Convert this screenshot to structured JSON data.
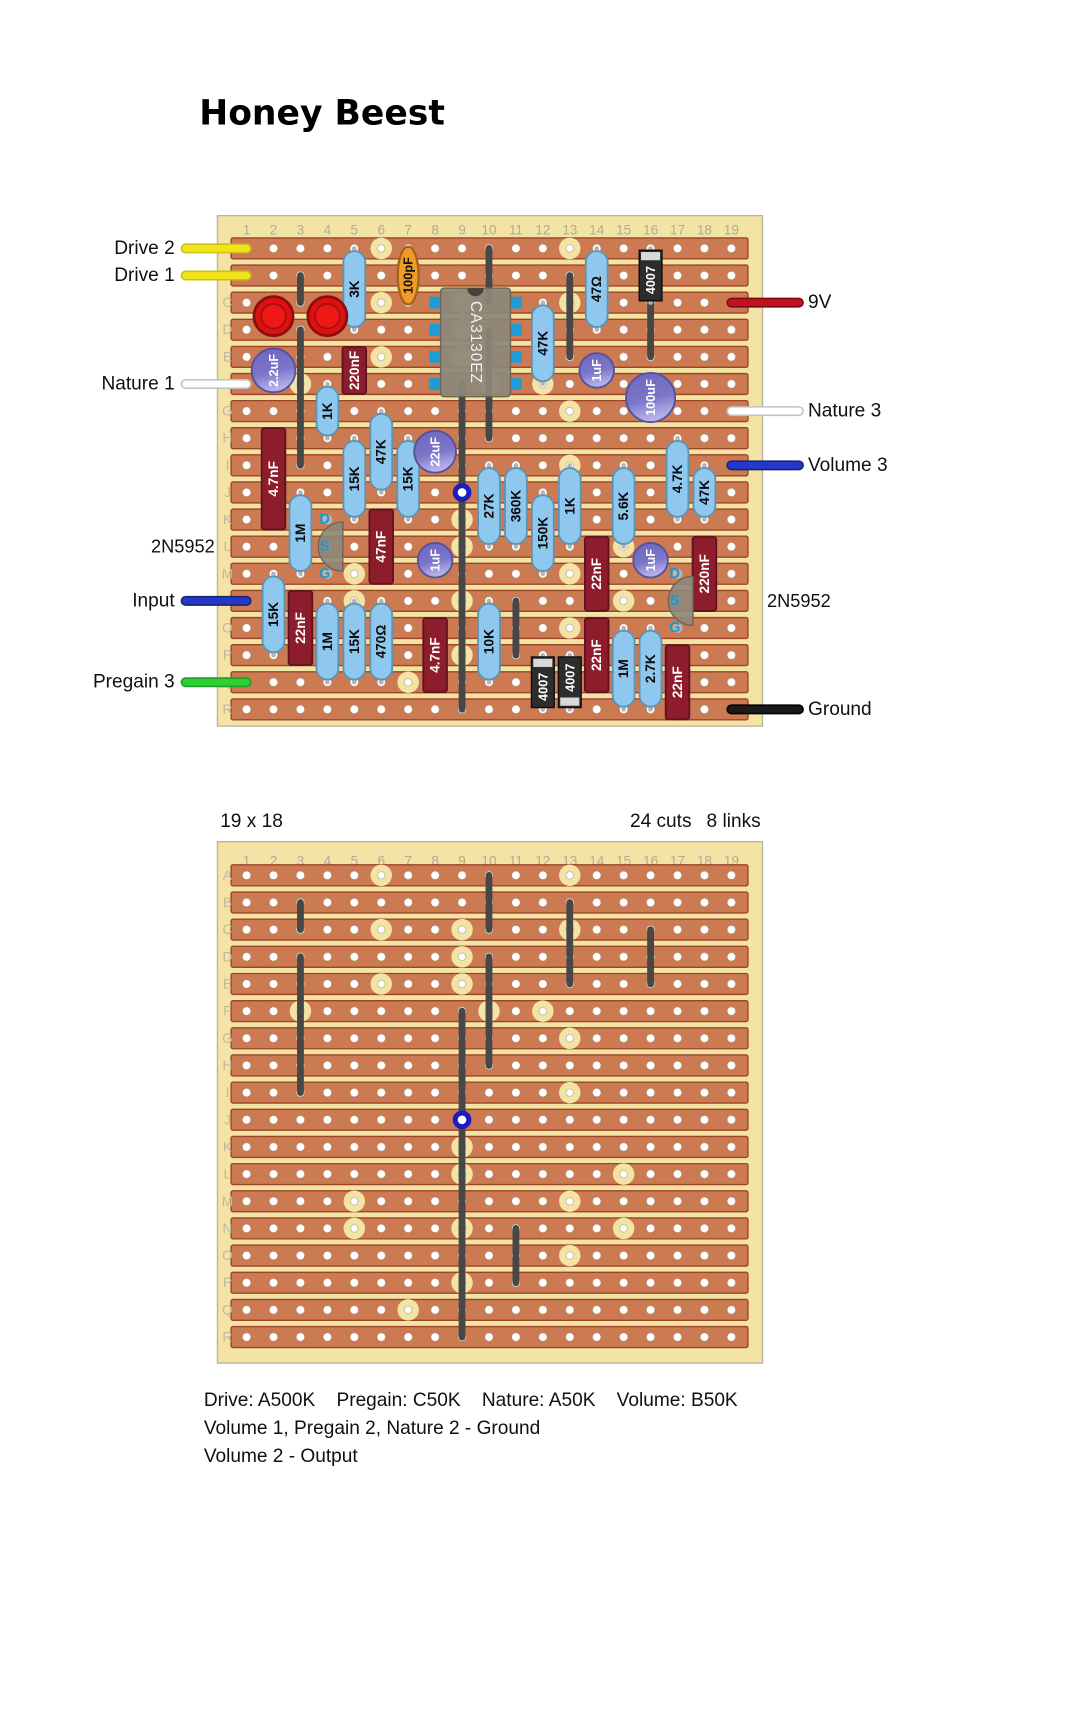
{
  "title": "Honey Beest",
  "board_meta": {
    "size_label": "19 x 18",
    "cuts_label": "24 cuts",
    "links_label": "8 links"
  },
  "captions": [
    "Drive: A500K    Pregain: C50K    Nature: A50K    Volume: B50K",
    "Volume 1, Pregain 2, Nature 2 - Ground",
    "Volume 2 - Output"
  ],
  "grid": {
    "columns": 19,
    "rows": "ABCDEFGHIJKLMNOPQR"
  },
  "connections": {
    "left": [
      {
        "label": "Drive 2",
        "row": "A",
        "color": "#f2e51c",
        "edge": "#cdc010"
      },
      {
        "label": "Drive 1",
        "row": "B",
        "color": "#f2e51c",
        "edge": "#cdc010"
      },
      {
        "label": "Nature 1",
        "row": "F",
        "color": "#ffffff",
        "edge": "#c3c3c3"
      },
      {
        "label": "Input",
        "row": "N",
        "color": "#2438cc",
        "edge": "#17246f"
      },
      {
        "label": "Pregain 3",
        "row": "Q",
        "color": "#2ecf35",
        "edge": "#1f9e28"
      }
    ],
    "right": [
      {
        "label": "9V",
        "row": "C",
        "color": "#c1121e",
        "edge": "#7d0a12"
      },
      {
        "label": "Nature 3",
        "row": "G",
        "color": "#ffffff",
        "edge": "#c3c3c3"
      },
      {
        "label": "Volume 3",
        "row": "I",
        "color": "#2438cc",
        "edge": "#17246f"
      },
      {
        "label": "Ground",
        "row": "R",
        "color": "#1a1a1a",
        "edge": "#000000"
      }
    ],
    "annotations": [
      {
        "label": "2N5952",
        "side": "left",
        "row": "L"
      },
      {
        "label": "2N5952",
        "side": "right",
        "row": "N"
      }
    ]
  },
  "components": {
    "resistors": [
      {
        "value": "3K",
        "col": 5,
        "from": "A",
        "to": "D"
      },
      {
        "value": "47Ω",
        "col": 14,
        "from": "A",
        "to": "D"
      },
      {
        "value": "47K",
        "col": 12,
        "from": "C",
        "to": "F"
      },
      {
        "value": "1K",
        "col": 4,
        "from": "F",
        "to": "H"
      },
      {
        "value": "47K",
        "col": 6,
        "from": "G",
        "to": "J"
      },
      {
        "value": "15K",
        "col": 5,
        "from": "H",
        "to": "K"
      },
      {
        "value": "15K",
        "col": 7,
        "from": "H",
        "to": "K"
      },
      {
        "value": "27K",
        "col": 10,
        "from": "I",
        "to": "L"
      },
      {
        "value": "360K",
        "col": 11,
        "from": "I",
        "to": "L"
      },
      {
        "value": "1K",
        "col": 13,
        "from": "I",
        "to": "L"
      },
      {
        "value": "5.6K",
        "col": 15,
        "from": "I",
        "to": "L"
      },
      {
        "value": "150K",
        "col": 12,
        "from": "J",
        "to": "M"
      },
      {
        "value": "4.7K",
        "col": 17,
        "from": "H",
        "to": "K"
      },
      {
        "value": "47K",
        "col": 18,
        "from": "I",
        "to": "K"
      },
      {
        "value": "1M",
        "col": 3,
        "from": "J",
        "to": "M"
      },
      {
        "value": "15K",
        "col": 2,
        "from": "M",
        "to": "P"
      },
      {
        "value": "1M",
        "col": 4,
        "from": "N",
        "to": "Q"
      },
      {
        "value": "15K",
        "col": 5,
        "from": "N",
        "to": "Q"
      },
      {
        "value": "470Ω",
        "col": 6,
        "from": "N",
        "to": "Q"
      },
      {
        "value": "10K",
        "col": 10,
        "from": "N",
        "to": "Q"
      },
      {
        "value": "1M",
        "col": 15,
        "from": "O",
        "to": "R"
      },
      {
        "value": "2.7K",
        "col": 16,
        "from": "O",
        "to": "R"
      }
    ],
    "film_caps": [
      {
        "value": "220nF",
        "col": 5,
        "from": "E",
        "to": "F"
      },
      {
        "value": "4.7nF",
        "col": 2,
        "from": "H",
        "to": "K"
      },
      {
        "value": "47nF",
        "col": 6,
        "from": "K",
        "to": "M"
      },
      {
        "value": "22nF",
        "col": 3,
        "from": "N",
        "to": "P"
      },
      {
        "value": "4.7nF",
        "col": 8,
        "from": "O",
        "to": "Q"
      },
      {
        "value": "22nF",
        "col": 14,
        "from": "L",
        "to": "N"
      },
      {
        "value": "220nF",
        "col": 18,
        "from": "L",
        "to": "N"
      },
      {
        "value": "22nF",
        "col": 14,
        "from": "O",
        "to": "Q"
      },
      {
        "value": "22nF",
        "col": 17,
        "from": "P",
        "to": "R"
      }
    ],
    "disc_caps": [
      {
        "value": "100pF",
        "col": 7,
        "from": "A",
        "to": "C"
      }
    ],
    "electrolytics": [
      {
        "value": "2.2uF",
        "col": 2,
        "from": "E",
        "to": "F",
        "r": 24
      },
      {
        "value": "1uF",
        "col": 14,
        "from": "E",
        "to": "F",
        "r": 19
      },
      {
        "value": "100uF",
        "col": 16,
        "from": "F",
        "to": "G",
        "r": 27
      },
      {
        "value": "22uF",
        "col": 8,
        "from": "H",
        "to": "I",
        "r": 23
      },
      {
        "value": "1uF",
        "col": 8,
        "from": "L",
        "to": "M",
        "r": 19
      },
      {
        "value": "1uF",
        "col": 16,
        "from": "L",
        "to": "M",
        "r": 19
      }
    ],
    "diodes": [
      {
        "value": "4007",
        "col": 16,
        "from": "A",
        "to": "C",
        "stripe": "top"
      },
      {
        "value": "4007",
        "col": 12,
        "from": "P",
        "to": "R",
        "stripe": "top"
      },
      {
        "value": "4007",
        "col": 13,
        "from": "P",
        "to": "R",
        "stripe": "bottom"
      }
    ],
    "leds": [
      {
        "col": 2,
        "from": "C",
        "to": "D"
      },
      {
        "col": 4,
        "from": "C",
        "to": "D"
      }
    ],
    "ics": [
      {
        "value": "CA3130EZ",
        "col_from": 8,
        "col_to": 11,
        "row_from": "C",
        "row_to": "F"
      }
    ],
    "transistors": [
      {
        "value": "2N5952",
        "col": 4,
        "pins": [
          "D",
          "S",
          "G"
        ],
        "rows": [
          "K",
          "L",
          "M"
        ]
      },
      {
        "value": "2N5952",
        "col": 17,
        "pins": [
          "D",
          "S",
          "G"
        ],
        "rows": [
          "M",
          "N",
          "O"
        ]
      }
    ]
  },
  "cuts": [
    "A6",
    "A13",
    "C6",
    "C9",
    "C13",
    "D9",
    "E6",
    "E9",
    "F3",
    "F10",
    "F12",
    "G13",
    "I13",
    "K9",
    "L9",
    "L15",
    "M5",
    "M13",
    "N5",
    "N9",
    "N15",
    "O13",
    "P9",
    "Q7"
  ],
  "links": [
    {
      "col": 3,
      "from": "B",
      "to": "C"
    },
    {
      "col": 3,
      "from": "D",
      "to": "I"
    },
    {
      "col": 9,
      "from": "F",
      "to": "R"
    },
    {
      "col": 10,
      "from": "A",
      "to": "C"
    },
    {
      "col": 10,
      "from": "D",
      "to": "H"
    },
    {
      "col": 11,
      "from": "N",
      "to": "P"
    },
    {
      "col": 13,
      "from": "B",
      "to": "E"
    },
    {
      "col": 16,
      "from": "C",
      "to": "E"
    }
  ],
  "junction": {
    "col": 9,
    "row": "J"
  },
  "colors": {
    "frame": "#f3e3a5",
    "frame_border": "#bdb597",
    "strip": "#cb7a51",
    "strip_border": "#9c4526",
    "hole": "#ffffff",
    "hole_ring": "#9b8372",
    "cut": "#f3e3a5",
    "link": "#474747",
    "lead": "#b5b5b5",
    "resistor": "#8fc8ee",
    "resistor_border": "#5e93b4",
    "film": "#8e1d2b",
    "film_border": "#5f1220",
    "ecap": "#7c76c8",
    "ecap_border": "#55509d",
    "ecap_light": "#b6b0e8",
    "disc": "#f09b28",
    "disc_border": "#a4621a",
    "diode": "#2d2d2d",
    "diode_stripe": "#d9d9d9",
    "ic": "#8d8779",
    "ic_border": "#6b655a",
    "ic_pad": "#1f9cd6",
    "ic_notch": "#46413a",
    "led": "#dc1111",
    "led_border": "#8f0c0c",
    "led_inner": "#f01717",
    "junction": "#1c1cc0",
    "pin_text": "#1899d6"
  },
  "geometry": {
    "scale": 0.9099,
    "pitch_x": 29.6,
    "col1_x": 271,
    "strip_x": 254,
    "strip_w": 568,
    "strip_h": 23,
    "top_board": {
      "x": 239,
      "y": 237,
      "w": 599,
      "h": 561,
      "col_label_y": 253,
      "rowA_y": 273,
      "pitch_y": 29.8,
      "row_label_x": 250
    },
    "bottom_board": {
      "x": 239,
      "y": 925,
      "w": 599,
      "h": 573,
      "col_label_y": 946,
      "rowA_y": 962,
      "pitch_y": 29.85,
      "row_label_x": 250
    },
    "title_pos": {
      "x": 219,
      "y": 137
    },
    "meta_y": 909,
    "meta_right_x": 836,
    "caption_x": 224,
    "caption_y": [
      1545,
      1576,
      1607
    ],
    "wire_left": {
      "x1": 204,
      "label_x": 192
    },
    "wire_right": {
      "x2": 878,
      "label_x": 888,
      "ann_x": 843
    },
    "ann_left_x": 236
  }
}
